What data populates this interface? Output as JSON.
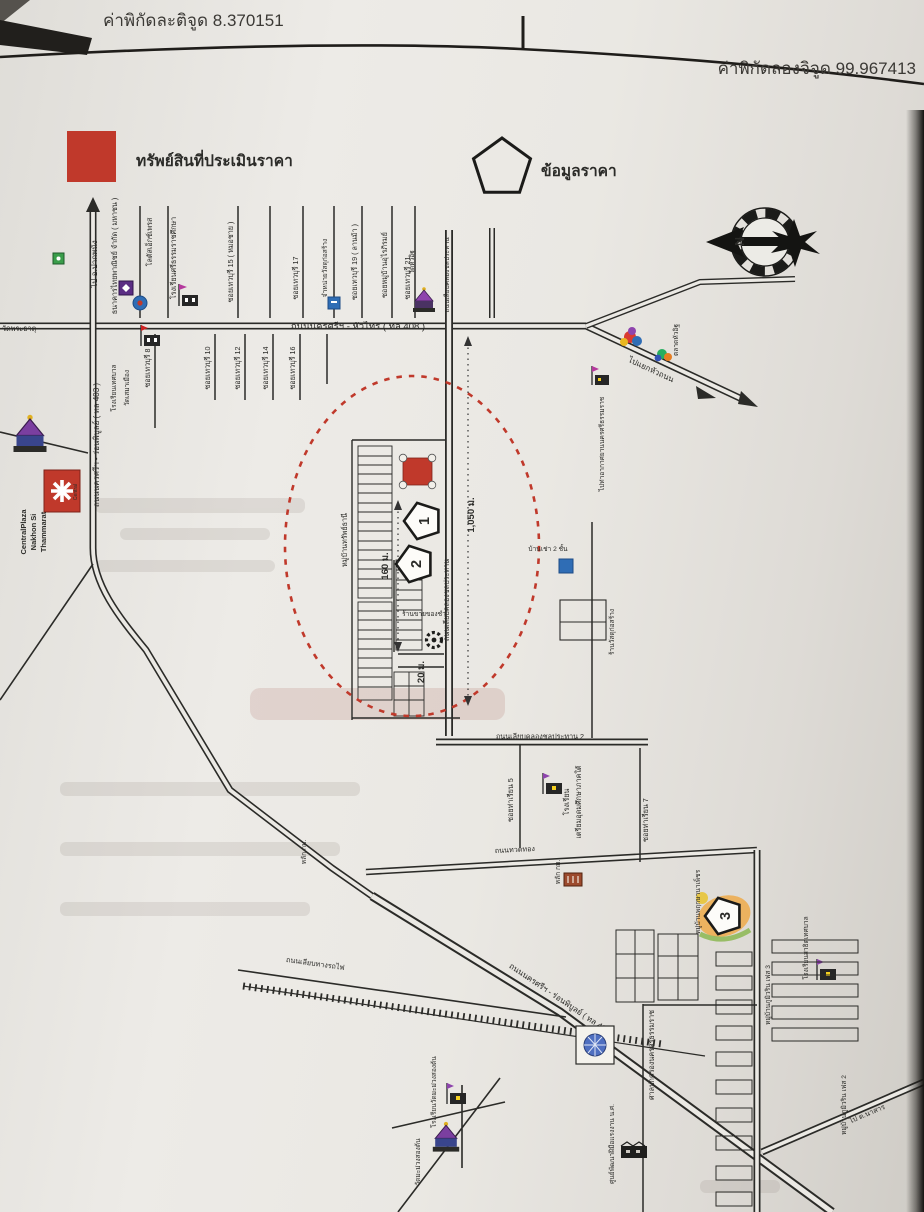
{
  "page": {
    "latitude": "ค่าพิกัดละติจูด 8.370151",
    "longitude": "ค่าพิกัดลองจิจูด 99.967413"
  },
  "legend": {
    "property": "ทรัพย์สินที่ประเมินราคา",
    "price": "ข้อมูลราคา"
  },
  "compass": {
    "north": "N"
  },
  "roads": {
    "hwy408": "ถนนนครศรีฯ - หัวไทร ( ทล 408 )",
    "hwy403": "ถนนนครศรีฯ - ร่อนพิบูลย์ ( ทล 403 )",
    "to_pakphanang": "ไป อ.ปากพนัง",
    "to_hua_thanon": "ไปแยกหัวถนน",
    "canal": "ถนนเลียบคลองชลประทาน",
    "canal2": "ถนนเลียบคลองชลประทาน 2",
    "railway_side": "ถนนเลียบทางรถไฟ",
    "thuadthong": "ถนนทวดทอง",
    "soi_tharian5": "ซอยท่าเรียน 5",
    "soi_tharian7": "ซอยท่าเรียน 7",
    "to_nasan": "ไป ต.นาสาร"
  },
  "sois_north": [
    "ซอยเทวบุรี 15 ( หมอชาย )",
    "ซอยเทวบุรี 17",
    "ซอยเทวบุรี 19 ( ลานม้า )",
    "ซอยหมู่บ้านอุไรภิรมย์",
    "ซอยเทวบุรี 21"
  ],
  "sois_south": [
    "ซอยเทวบุรี 8",
    "ซอยเทวบุรี 10",
    "ซอยเทวบุรี 12",
    "ซอยเทวบุรี 14",
    "ซอยเทวบุรี 16"
  ],
  "places": {
    "scb": "ธนาคารไทยพาณิชย์ จำกัด ( มหาชน )",
    "lotus": "โลตัสเอ็กซ์เพรส",
    "sri_school": "โรงเรียนศรีธรรมราชศึกษา",
    "material_store": "จำหน่ายวัสดุก่อสร้าง",
    "wat_hua_it": "วัดหัวอิฐ",
    "hua_it_market": "ตลาดหัวอิฐ",
    "wat_phrathat": "วัดพระธาตุ",
    "sema_school1": "โรงเรียนเทศบาล",
    "sema_school2": "วัดเสมาเมือง",
    "central1": "CentralPlaza",
    "central2": "Nakhon Si",
    "central3": "Thammarat",
    "central_logo": "Central",
    "village": "หมู่บ้านทรัพย์ธานี",
    "grocery": "ร้านขายของชำ",
    "rental": "บ้านเช่า 2 ชั้น",
    "material_shop2": "ร้านวัสดุก่อสร้าง",
    "airport": "ไปท่าอากาศยานนครศรีธรรมราช",
    "triam1": "โรงเรียน",
    "triam2": "เตรียมอุดมศึกษาภาคใต้",
    "admin_court": "ศาลปกครองนครศรีธรรมราช",
    "skill_center": "ศูนย์พัฒนาฝีมือแรงงาน น.ศ.",
    "wat_mamuang": "วัดมะม่วงสองต้น",
    "mamuang_school": "โรงเรียนวัดมะม่วงสองต้น",
    "pruksa": "หมู่บ้านพฤกษานาเพ็ชร",
    "phum2": "หมู่บ้านภูมิวริน เฟส 2",
    "phum3": "หมู่บ้านภูมิวริน เฟส 3",
    "satit_school": "โรงเรียนสาธิตเทศบาล",
    "km_post": "หลัก กม."
  },
  "markers": {
    "p1": "1",
    "p2": "2",
    "p3": "3"
  },
  "distances": {
    "d1050": "1,050 ม.",
    "d160": "160 ม.",
    "d20": "20 ม."
  },
  "colors": {
    "property_red": "#c0392b",
    "circle_red": "#c0392b",
    "ink": "#2b2b28"
  }
}
